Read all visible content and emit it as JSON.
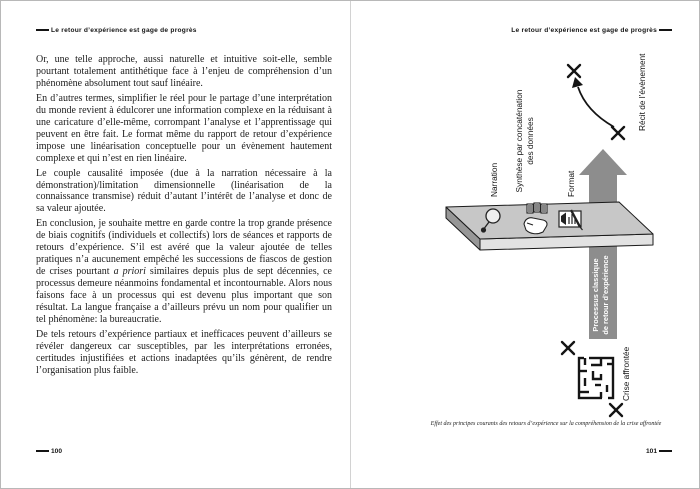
{
  "book": {
    "running_title": "Le retour d’expérience est gage de progrès",
    "left_page": {
      "number": "100",
      "paragraphs": [
        {
          "text": "Or, une telle approche, aussi naturelle et intuitive soit-elle, semble pourtant totalement antithétique face à l’enjeu de compréhension d’un phénomène absolument tout sauf linéaire."
        },
        {
          "text": "En d’autres termes, simplifier le réel pour le partage d’une interprétation du monde revient à édulcorer une information complexe en la réduisant à une caricature d’elle-même, corrompant l’analyse et l’apprentissage qui peuvent en être fait. Le format même du rapport de retour d’expérience impose une linéarisation conceptuelle pour un évènement hautement complexe et qui n’est en rien linéaire."
        },
        {
          "text": "Le couple causalité imposée (due à la narration nécessaire à la démonstration)/limitation dimensionnelle (linéarisation de la connaissance transmise) réduit d’autant l’intérêt de l’analyse et donc de sa valeur ajoutée."
        },
        {
          "pre": "En conclusion, je souhaite mettre en garde contre la trop grande présence de biais cognitifs (individuels et collectifs) lors de séances et rapports de retours d’expérience. S’il est avéré que la valeur ajoutée de telles pratiques n’a aucunement empêché les successions de fiascos de gestion de crises pourtant ",
          "italic": "a priori",
          "post": " similaires depuis plus de sept décennies, ce processus demeure néanmoins fondamental et incontournable. Alors nous faisons face à un processus qui est devenu plus important que son résultat. La langue française a d’ailleurs prévu un nom pour qualifier un tel phénomène: la bureaucratie."
        },
        {
          "text": "De tels retours d’expérience partiaux et inefficaces peuvent d’ailleurs se révéler dangereux car susceptibles, par les interprétations erronées, certitudes injustifiées et actions inadaptées qu’ils génèrent, de rendre l’organisation plus faible."
        }
      ]
    },
    "right_page": {
      "number": "101",
      "caption": "Effet des principes courants des retours d’expérience sur la compréhension de la crise affrontée",
      "figure": {
        "labels": {
          "narration": "Narration",
          "synthese_l1": "Synthèse par concaténation",
          "synthese_l2": "des données",
          "format": "Format",
          "recit": "Récit de l’évènement",
          "processus_l1": "Processus classique",
          "processus_l2": "de retour d’expérience",
          "crise": "Crise affrontée"
        },
        "icons": [
          "speech-bubble-icon",
          "hand-cards-icon",
          "document-chart-icon",
          "maze-icon",
          "x-mark",
          "up-arrow",
          "curved-arrow"
        ],
        "colors": {
          "platform_top": "#c7c7c7",
          "platform_front": "#e2e2e2",
          "platform_side": "#979797",
          "arrow_gray": "#8d8d8d",
          "ink": "#161616"
        }
      }
    }
  }
}
